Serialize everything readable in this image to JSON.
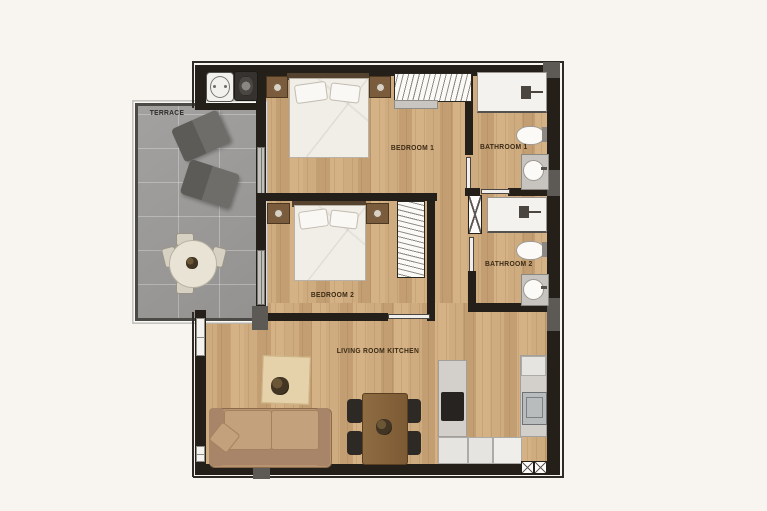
{
  "plan": {
    "title": "2-bedroom apartment floor plan",
    "labels": {
      "terrace": "TERRACE",
      "bedroom1": "BEDROOM 1",
      "bathroom1": "BATHROOM 1",
      "bedroom2": "BEDROOM 2",
      "bathroom2": "BATHROOM 2",
      "living": "LIVING ROOM KITCHEN"
    },
    "rooms": [
      {
        "name": "Terrace"
      },
      {
        "name": "Bedroom 1"
      },
      {
        "name": "Bathroom 1"
      },
      {
        "name": "Bedroom 2"
      },
      {
        "name": "Bathroom 2"
      },
      {
        "name": "Living Room Kitchen"
      }
    ],
    "colors": {
      "background": "#f8f5f1",
      "wall": "#242019",
      "wood_floor": "#c9a77c",
      "terrace_floor": "#9b9997",
      "terrace_furniture": "#6f6d6a",
      "counter": "#d3d0cb",
      "fixture_white": "#f4f2ee",
      "sofa": "#b7946f",
      "dining_table": "#85613a",
      "label_text": "#3c2b16"
    }
  }
}
